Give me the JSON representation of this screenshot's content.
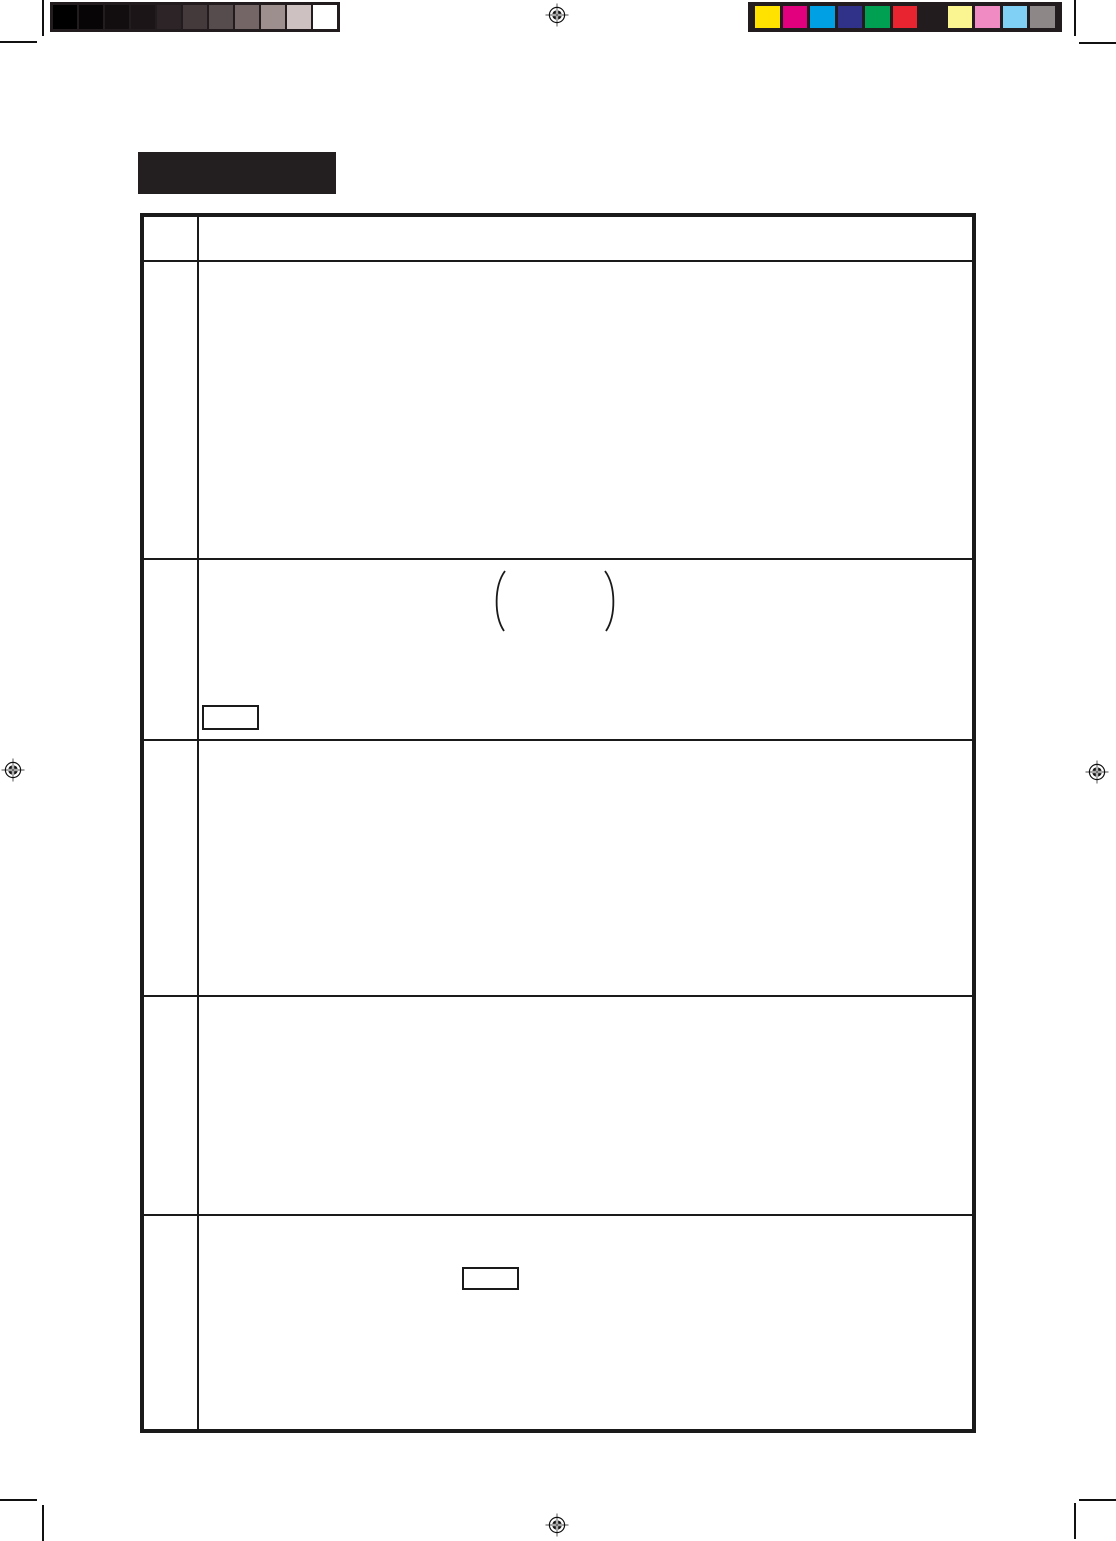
{
  "page": {
    "background_color": "#ffffff",
    "kind": "print-proof scanned manual page",
    "visible_text": ""
  },
  "header": {
    "title_box": {
      "label": "",
      "fill_color": "#231f20"
    }
  },
  "calibration": {
    "grayscale_bar": {
      "frame_color": "#231c1e",
      "colors": [
        "#000000",
        "#070506",
        "#120e0f",
        "#1c1517",
        "#2c2426",
        "#443a3b",
        "#574c4d",
        "#746667",
        "#9c8f8e",
        "#cdc2c1",
        "#ffffff"
      ]
    },
    "color_bar": {
      "frame_color": "#231c1e",
      "colors": [
        "#ffe200",
        "#e3007f",
        "#00a0e4",
        "#2f3288",
        "#00a053",
        "#e72430",
        "#231c1e",
        "#faf491",
        "#f08bc3",
        "#80cff5",
        "#8e8787"
      ]
    }
  },
  "registration_marks": {
    "color": "#111111",
    "positions": [
      "top-center",
      "left-middle",
      "right-middle",
      "bottom-center"
    ]
  },
  "crop_marks": {
    "color": "#111111",
    "positions": [
      "top-left",
      "top-right",
      "bottom-left",
      "bottom-right"
    ]
  },
  "table": {
    "border_color": "#1a1a1a",
    "columns": [
      {
        "label": ""
      },
      {
        "label": ""
      }
    ],
    "rows": [
      {
        "left": "",
        "body": ""
      },
      {
        "left": "",
        "body": ""
      },
      {
        "left": "",
        "body": "",
        "decoration": "large-parentheses",
        "note_box": ""
      },
      {
        "left": "",
        "body": ""
      },
      {
        "left": "",
        "body": ""
      },
      {
        "left": "",
        "body": "",
        "note_box": ""
      }
    ],
    "parentheses_glyphs": "( )"
  }
}
